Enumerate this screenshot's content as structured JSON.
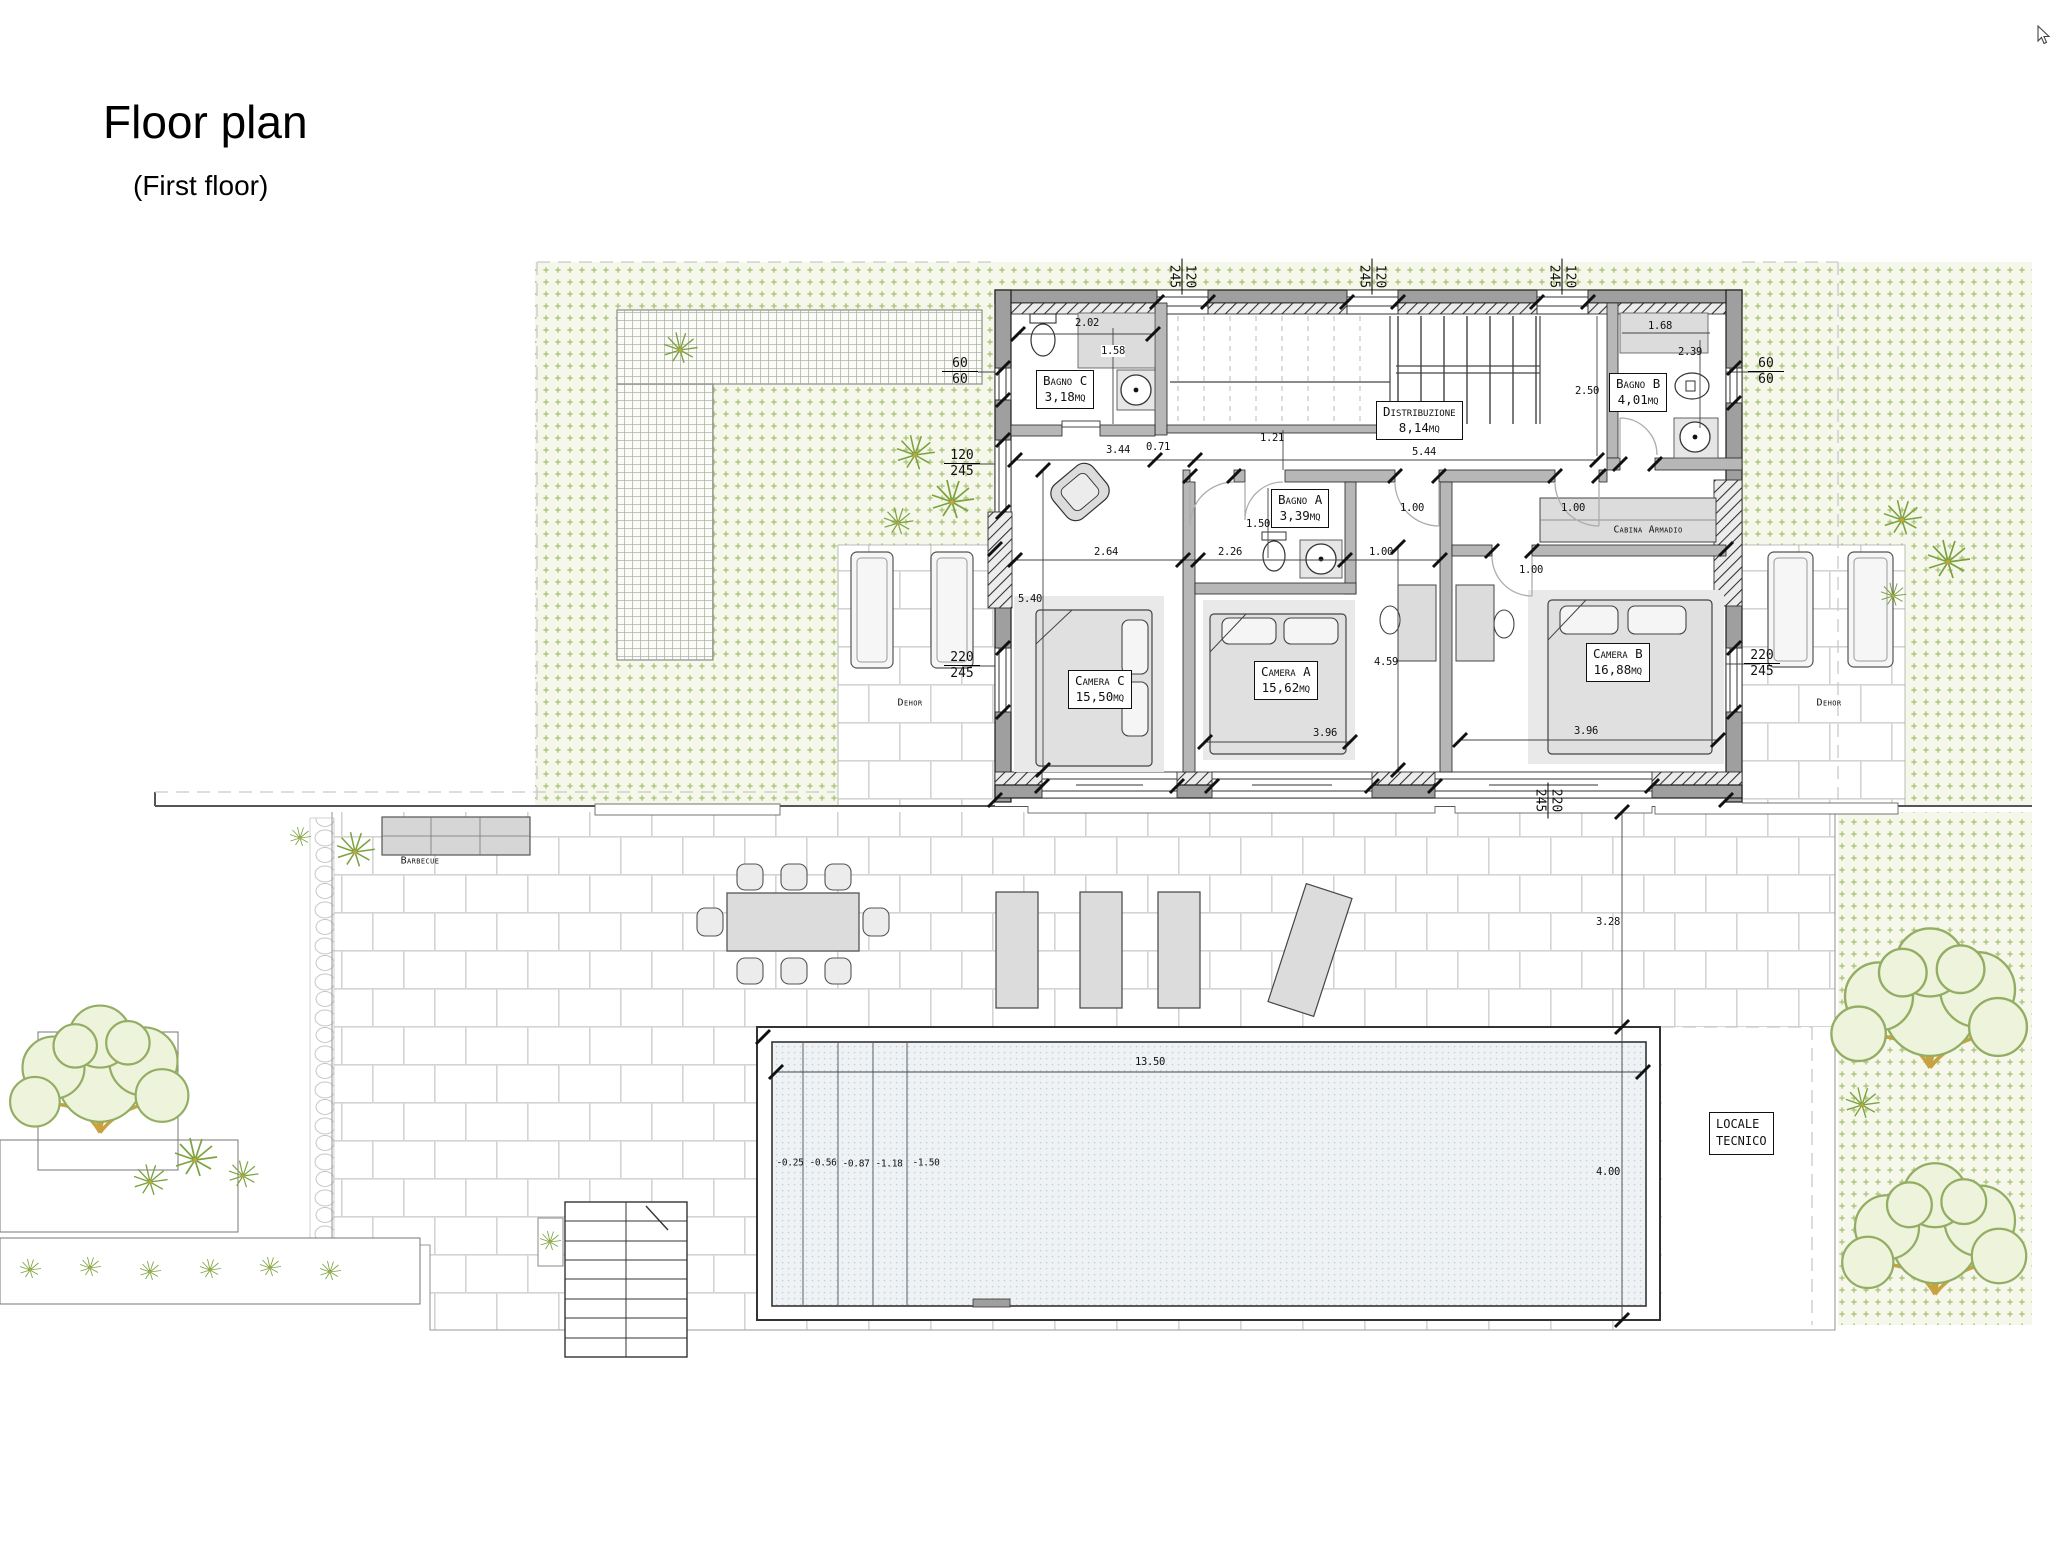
{
  "title": {
    "main": "Floor plan",
    "sub": "(First floor)"
  },
  "rooms": {
    "bagno_c": {
      "name": "Bagno C",
      "area": "3,18mq"
    },
    "distribuzione": {
      "name": "Distribuzione",
      "area": "8,14mq"
    },
    "bagno_b": {
      "name": "Bagno B",
      "area": "4,01mq"
    },
    "bagno_a": {
      "name": "Bagno A",
      "area": "3,39mq"
    },
    "camera_c": {
      "name": "Camera C",
      "area": "15,50mq"
    },
    "camera_a": {
      "name": "Camera A",
      "area": "15,62mq"
    },
    "camera_b": {
      "name": "Camera B",
      "area": "16,88mq"
    },
    "cabina_armadio": {
      "name": "Cabina Armadio"
    },
    "dehor_left": {
      "name": "Dehor"
    },
    "dehor_right": {
      "name": "Dehor"
    },
    "barbecue": {
      "name": "Barbecue"
    },
    "locale_tecnico": {
      "line1": "LOCALE",
      "line2": "TECNICO"
    }
  },
  "dims": [
    {
      "t": "2.02"
    },
    {
      "t": "1.58"
    },
    {
      "t": "3.44"
    },
    {
      "t": "0.71"
    },
    {
      "t": "1.21"
    },
    {
      "t": "5.44"
    },
    {
      "t": "2.50"
    },
    {
      "t": "1.68"
    },
    {
      "t": "2.39"
    },
    {
      "t": "1.50"
    },
    {
      "t": "2.26"
    },
    {
      "t": "1.00"
    },
    {
      "t": "1.00"
    },
    {
      "t": "1.00"
    },
    {
      "t": "1.00"
    },
    {
      "t": "2.64"
    },
    {
      "t": "5.40"
    },
    {
      "t": "4.59"
    },
    {
      "t": "3.96"
    },
    {
      "t": "3.96"
    },
    {
      "t": "13.50"
    },
    {
      "t": "3.28"
    },
    {
      "t": "4.00"
    },
    {
      "t": "-0.25"
    },
    {
      "t": "-0.56"
    },
    {
      "t": "-0.87"
    },
    {
      "t": "-1.18"
    },
    {
      "t": "-1.50"
    }
  ],
  "window_labels": [
    {
      "a": "60",
      "b": "60"
    },
    {
      "a": "60",
      "b": "60"
    },
    {
      "a": "120",
      "b": "245"
    },
    {
      "a": "220",
      "b": "245"
    },
    {
      "a": "220",
      "b": "245"
    },
    {
      "a": "120",
      "b": "245"
    },
    {
      "a": "120",
      "b": "245"
    },
    {
      "a": "120",
      "b": "245"
    },
    {
      "a": "220",
      "b": "245"
    }
  ],
  "colors": {
    "wall": "#9f9f9f",
    "wall_inner": "#b7b7b7",
    "furniture": "#dcdcdc",
    "garden_bg": "#f4f7e9",
    "garden_dot": "#b3c784",
    "brick_line": "#d4d4d4",
    "pool_fill": "#eef2f4",
    "pool_dot": "#c2ccd3",
    "leaf_green": "#93ad62",
    "branch_tan": "#c9a23f"
  }
}
